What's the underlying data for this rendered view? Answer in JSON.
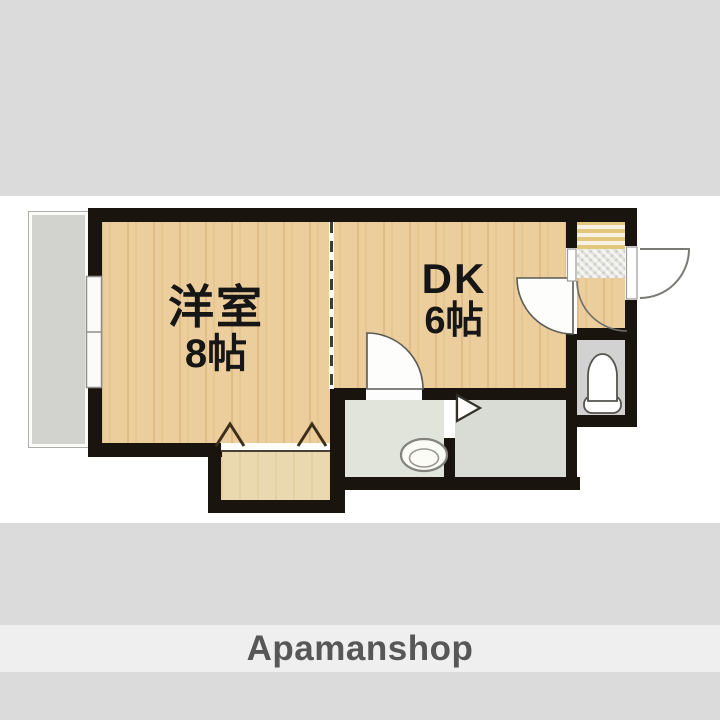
{
  "floor_plan": {
    "western_room": {
      "label": "洋室",
      "size": "8帖"
    },
    "dining_kitchen": {
      "label": "DK",
      "size": "6帖"
    },
    "fixtures": {
      "balcony": "balcony",
      "window": "sliding-window",
      "closet": "closet-with-folding-doors",
      "bathtub": "bathtub",
      "toilet": "toilet",
      "washbasin": "washbasin",
      "kitchen": "kitchen-counter-with-sink",
      "entrance": "entrance-door-outswing",
      "partition": "dashed-room-divider"
    },
    "colors": {
      "wall": "#19140e",
      "wood_floor": "#ecce9c",
      "bathtub_fill": "#4fd9dd",
      "balcony_floor": "#d2d2cf",
      "kitchen_stripe": "#e2c77c",
      "wet_area_floor": "#e0e4db",
      "background_band": "#dbdbdb",
      "logo_band": "#efefef"
    }
  },
  "footer": {
    "brand": "Apamanshop"
  }
}
